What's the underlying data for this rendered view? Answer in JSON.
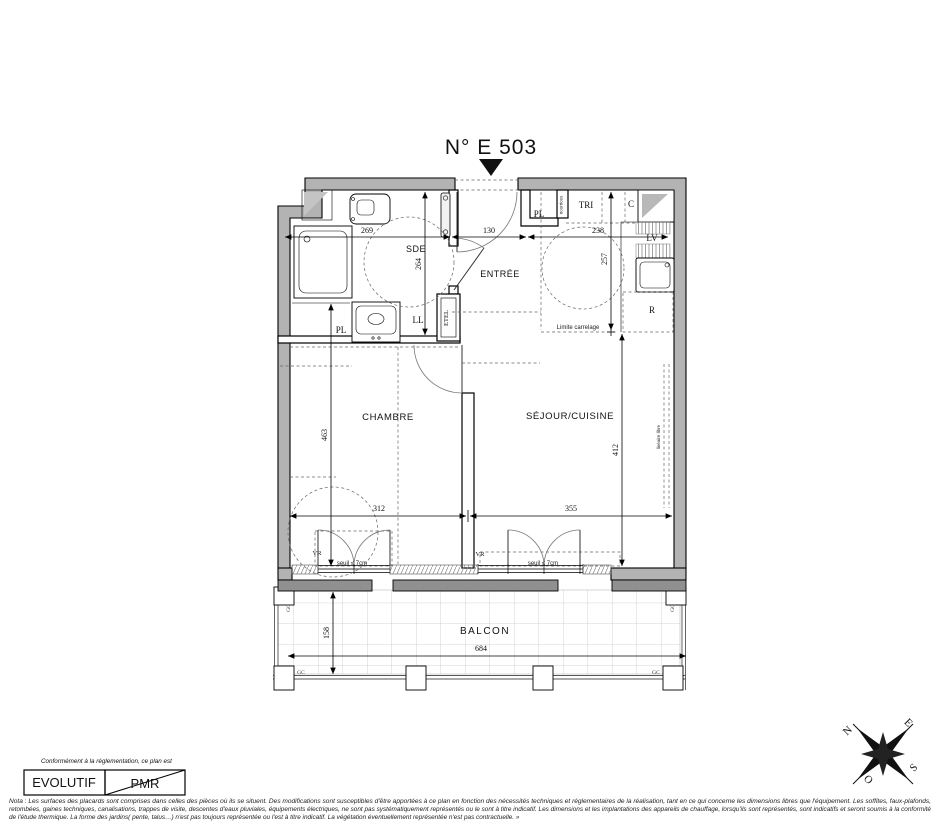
{
  "title": "N° E 503",
  "colors": {
    "wall_fill": "#b3b3b3",
    "slab_fill": "#909090",
    "line": "#111111"
  },
  "plan": {
    "rooms": {
      "sde": "SDE",
      "entree": "ENTRÉE",
      "chambre": "CHAMBRE",
      "sejour": "SÉJOUR/CUISINE",
      "balcon": "BALCON"
    },
    "closets": {
      "pl": "PL",
      "tri": "TRI",
      "c": "C"
    },
    "equipment": {
      "lv": "LV",
      "r": "R",
      "ll": "LL",
      "etel": "ETEL",
      "nourrices": "nourrices"
    },
    "annotations": {
      "limite": "Limite carrelage",
      "lineaire": "linéaire libre",
      "vr": "VR",
      "seuil": "seuil ≤ 7cm",
      "gc": "GC"
    },
    "dimensions": {
      "sde_width": "269",
      "entree_width": "130",
      "tri_width": "238",
      "sde_height": "264",
      "kitchen_height": "257",
      "chambre_height": "463",
      "sejour_height": "412",
      "chambre_width": "312",
      "sejour_width": "355",
      "balcon_height": "158",
      "balcon_width": "684"
    }
  },
  "compass": {
    "n": "N",
    "e": "E",
    "s": "S",
    "o": "O"
  },
  "legend": {
    "caption": "Conformément à la réglementation, ce plan est",
    "evolutif": "EVOLUTIF",
    "pmr": "PMR"
  },
  "nota": {
    "line1": "Nota : Les surfaces des placards sont comprises dans celles des pièces où ils se situent. Des modifications sont susceptibles d'être apportées à ce plan en fonction des nécessités techniques et réglementaires de la réalisation, tant en ce qui concerne les dimensions libres que l'équipement.  Les soffites, faux-plafonds,",
    "line2": "retombées, gaines techniques, canalisations, trappes de visite, descentes d'eaux pluviales, équipements électriques, ne sont pas systématiquement représentés ou le sont à titre indicatif. Les dimensions et les implantations des appareils de chauffage, lorsqu'ils sont représentés, sont indicatifs et seront soumis à la conformité",
    "line3": "de l'étude thermique. La forme des jardins( pente, talus…) n'est pas toujours représentée ou l'est à titre indicatif. La végétation éventuellement représentée n'est pas contractuelle. »"
  }
}
